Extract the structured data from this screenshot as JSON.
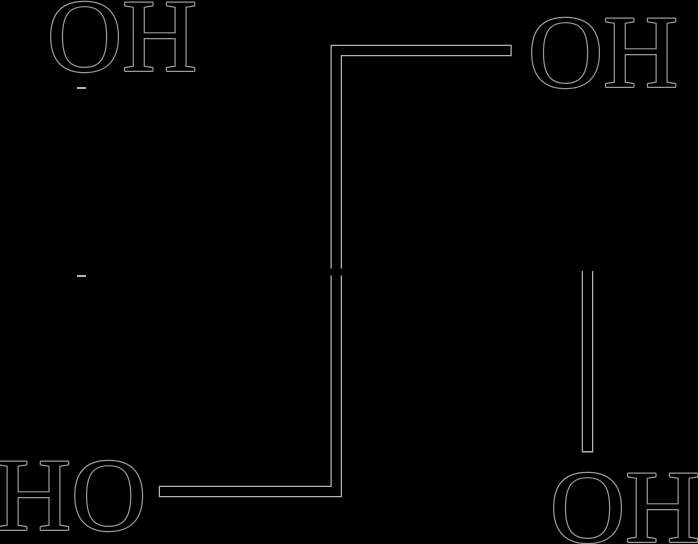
{
  "figure": {
    "type": "chemical-structure-diagram",
    "molecule_hint": "tetraol skeletal formula with four hydroxyl groups",
    "background_color": "#000000",
    "ink_color": "#000000",
    "bond_halo_color": "#b2b2b2",
    "text_halo_color": "#989898"
  },
  "labels": {
    "top_left": "OH",
    "top_right": "OH",
    "bottom_left": "HO",
    "bottom_right": "OH"
  }
}
